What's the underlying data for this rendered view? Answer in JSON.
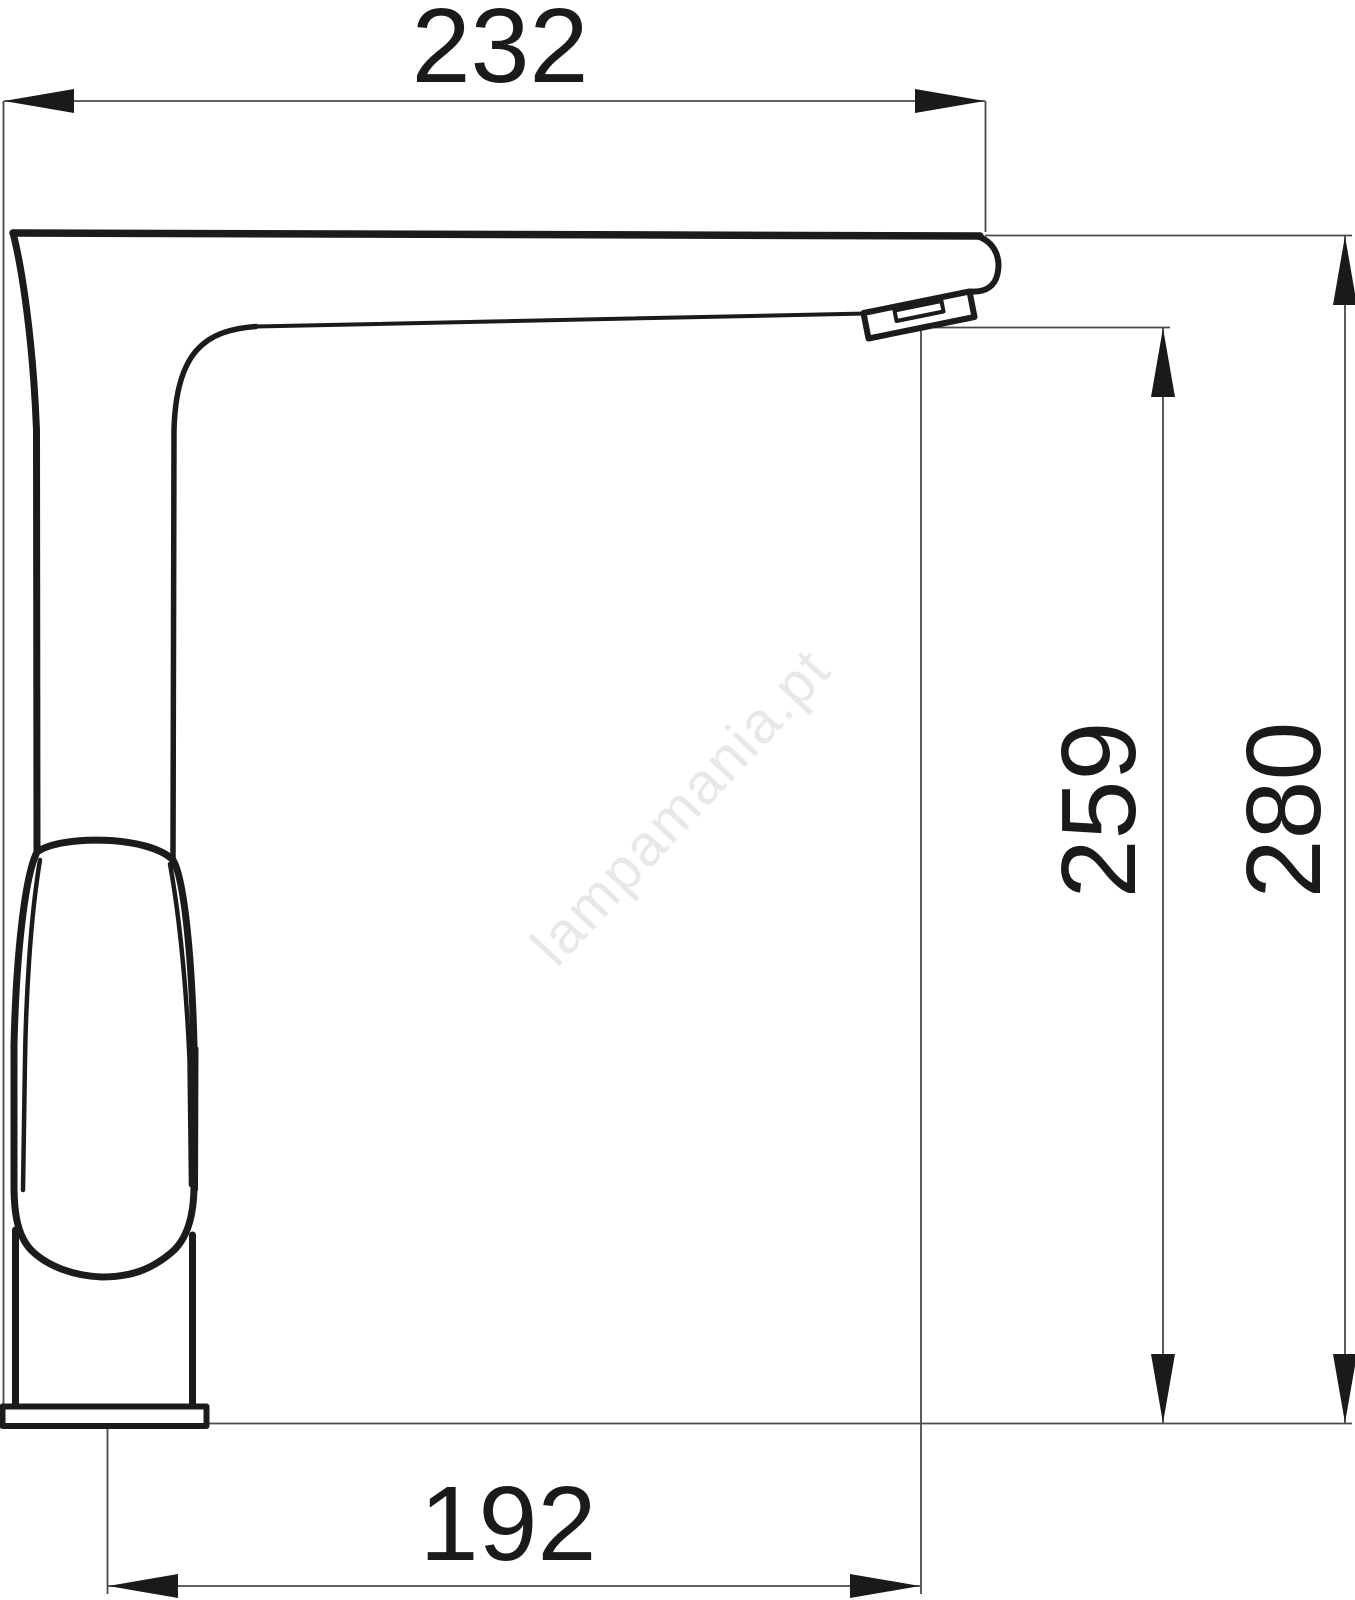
{
  "dimensions": {
    "overall_width": "232",
    "outlet_height": "259",
    "overall_height": "280",
    "spout_reach": "192"
  },
  "watermark": "lampamania.pt",
  "colors": {
    "bg": "#ffffff",
    "outline": "#1b1b1b",
    "dim": "#4a4a4a",
    "label": "#1a1a1a",
    "wm": "#e8e8e8"
  }
}
